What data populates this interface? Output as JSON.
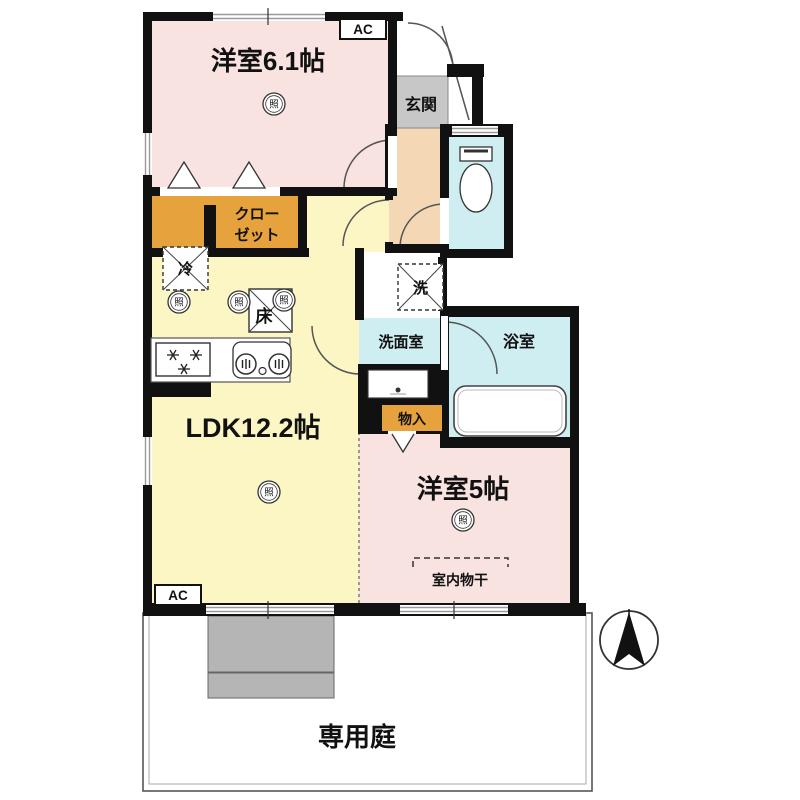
{
  "floorplan": {
    "rooms": {
      "western_room_61": {
        "label": "洋室6.1帖"
      },
      "entrance": {
        "label": "玄関"
      },
      "closet": {
        "line1": "クロー",
        "line2": "ゼット"
      },
      "ldk": {
        "label": "LDK12.2帖"
      },
      "washroom": {
        "label": "洗面室"
      },
      "bathroom": {
        "label": "浴室"
      },
      "storage": {
        "label": "物入"
      },
      "western_room_5": {
        "label": "洋室5帖"
      },
      "garden": {
        "label": "専用庭"
      }
    },
    "annotations": {
      "ac": "AC",
      "washer": "洗",
      "refrigerator": "冷",
      "floor_storage": "床",
      "light": "照",
      "indoor_drying": "室内物干"
    },
    "colors": {
      "wall": "#111111",
      "room_pink": "#f9e3e1",
      "room_yellow": "#fbf6c4",
      "closet_orange": "#e6a23c",
      "entrance_gray": "#c7c7c7",
      "hallway_peach": "#f4d7b5",
      "water_cyan": "#cfeef1",
      "terrace_gray": "#b5b5b5"
    }
  }
}
